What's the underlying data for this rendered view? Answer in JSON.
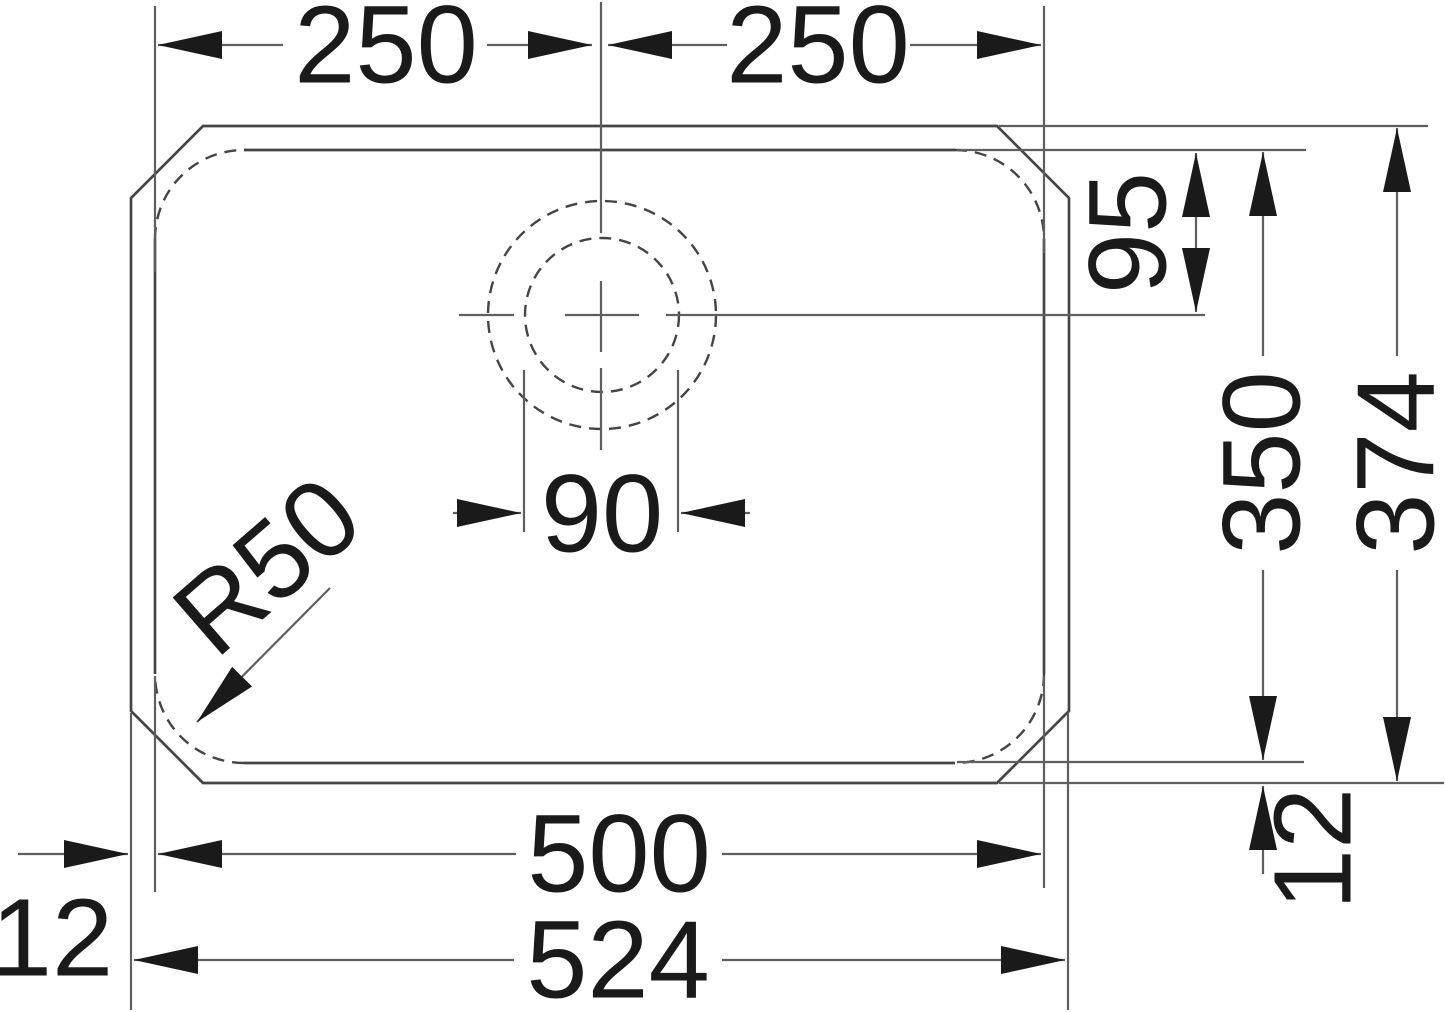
{
  "drawing": {
    "type": "technical-dimension-drawing",
    "subject": "rectangular sink bowl with drain hole, top view",
    "units": "mm",
    "dimensions": {
      "half_width_left": "250",
      "half_width_right": "250",
      "drain_center_from_top_edge": "95",
      "drain_hole_diameter": "90",
      "corner_radius": "R50",
      "bowl_depth": "350",
      "overall_depth": "374",
      "rim_offset_bottom_right": "12",
      "bowl_width": "500",
      "overall_width": "524",
      "rim_offset_left": "12"
    },
    "colors": {
      "line": "#5f5f5f",
      "shape": "#454545",
      "text": "#1a1a1a",
      "background": "#ffffff"
    }
  }
}
